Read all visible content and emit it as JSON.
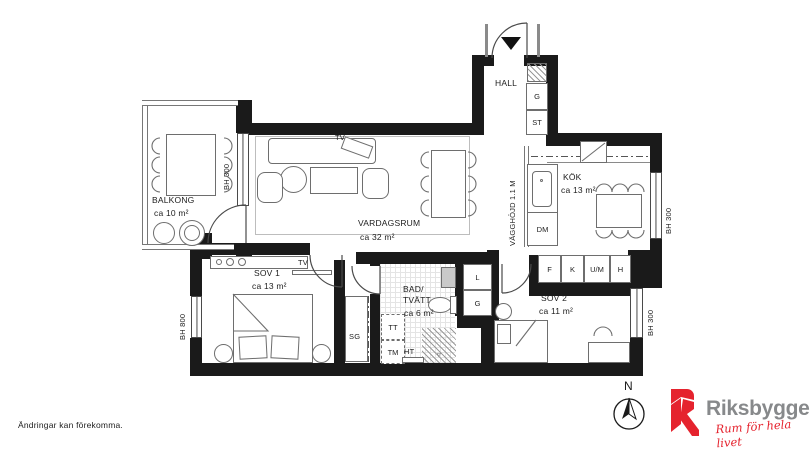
{
  "disclaimer": "Ändringar kan förekomma.",
  "brand": {
    "name": "Riksbyggen",
    "tagline": "Rum för hela livet"
  },
  "compass": {
    "north": "N"
  },
  "rooms": {
    "hall": {
      "name": "HALL"
    },
    "kok": {
      "name": "KÖK",
      "area": "ca 13 m²"
    },
    "vardagsrum": {
      "name": "VARDAGSRUM",
      "area": "ca 32 m²"
    },
    "balkong": {
      "name": "BALKONG",
      "area": "ca 10 m²"
    },
    "sov1": {
      "name": "SOV 1",
      "area": "ca 13 m²"
    },
    "sov2": {
      "name": "SOV 2",
      "area": "ca 11 m²"
    },
    "bad": {
      "name1": "BAD/",
      "name2": "TVÄTT",
      "area": "ca 6 m²"
    }
  },
  "closets": {
    "g_hall": "G",
    "st": "ST",
    "sg": "SG",
    "l": "L",
    "g_bad": "G"
  },
  "appliances": {
    "dm": "DM",
    "tt": "TT",
    "tm": "TM",
    "ht": "HT",
    "f": "F",
    "k": "K",
    "um": "U/M",
    "h": "H"
  },
  "tv": {
    "living": "TV",
    "sov1": "TV"
  },
  "annotations": {
    "bh300_balkong": "BH 300",
    "bh300_kok": "BH 300",
    "bh300_sov2": "BH 300",
    "bh800": "BH 800",
    "vagghojd": "VÄGGHÖJD 1.1 M"
  },
  "colors": {
    "wall": "#1a1a1a",
    "line": "#6e6e6e",
    "brand_red": "#e5232e",
    "brand_gray": "#87898b"
  }
}
